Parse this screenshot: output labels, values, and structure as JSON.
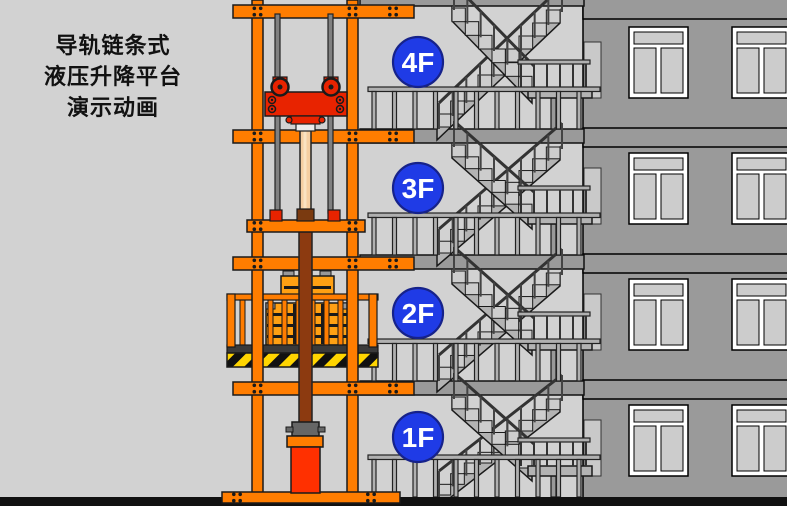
{
  "title": {
    "line1": "导轨链条式",
    "line2": "液压升降平台",
    "line3": "演示动画"
  },
  "floors": [
    {
      "label": "4F",
      "badge_cx": 418,
      "badge_cy": 62,
      "zone_top": 6,
      "zone_bottom": 129,
      "landing_y": 88
    },
    {
      "label": "3F",
      "badge_cx": 418,
      "badge_cy": 188,
      "zone_top": 143,
      "zone_bottom": 255,
      "landing_y": 214
    },
    {
      "label": "2F",
      "badge_cx": 418,
      "badge_cy": 313,
      "zone_top": 269,
      "zone_bottom": 381,
      "landing_y": 340
    },
    {
      "label": "1F",
      "badge_cx": 418,
      "badge_cy": 437,
      "zone_top": 395,
      "zone_bottom": 497,
      "landing_y": 466
    }
  ],
  "colors": {
    "background": "#D2D2D2",
    "facade_wall": "#9A9A9A",
    "slab": "#9A9A9A",
    "window_frame": "#FFFFFF",
    "window_pane": "#CCCCCC",
    "structure_orange": "#FF7D00",
    "carriage_red": "#E82300",
    "cylinder_red": "#FF3000",
    "piston_tan": "#F6CFA2",
    "piston_highlight": "#FBE3C2",
    "rod_brown": "#8C3A10",
    "cap_brown": "#7A3A10",
    "cargo_orange": "#FFA013",
    "hazard_yellow": "#FFD500",
    "badge_blue": "#1F3BE6",
    "badge_text": "#FFFFFF",
    "stair_gray": "#B3B3B3",
    "step_gray": "#CDCDCD",
    "rail_gray": "#B0B0B0",
    "metal_gray": "#808080",
    "dark": "#1A1A1A",
    "deck_dark": "#3A3A3A",
    "ground": "#111111"
  }
}
